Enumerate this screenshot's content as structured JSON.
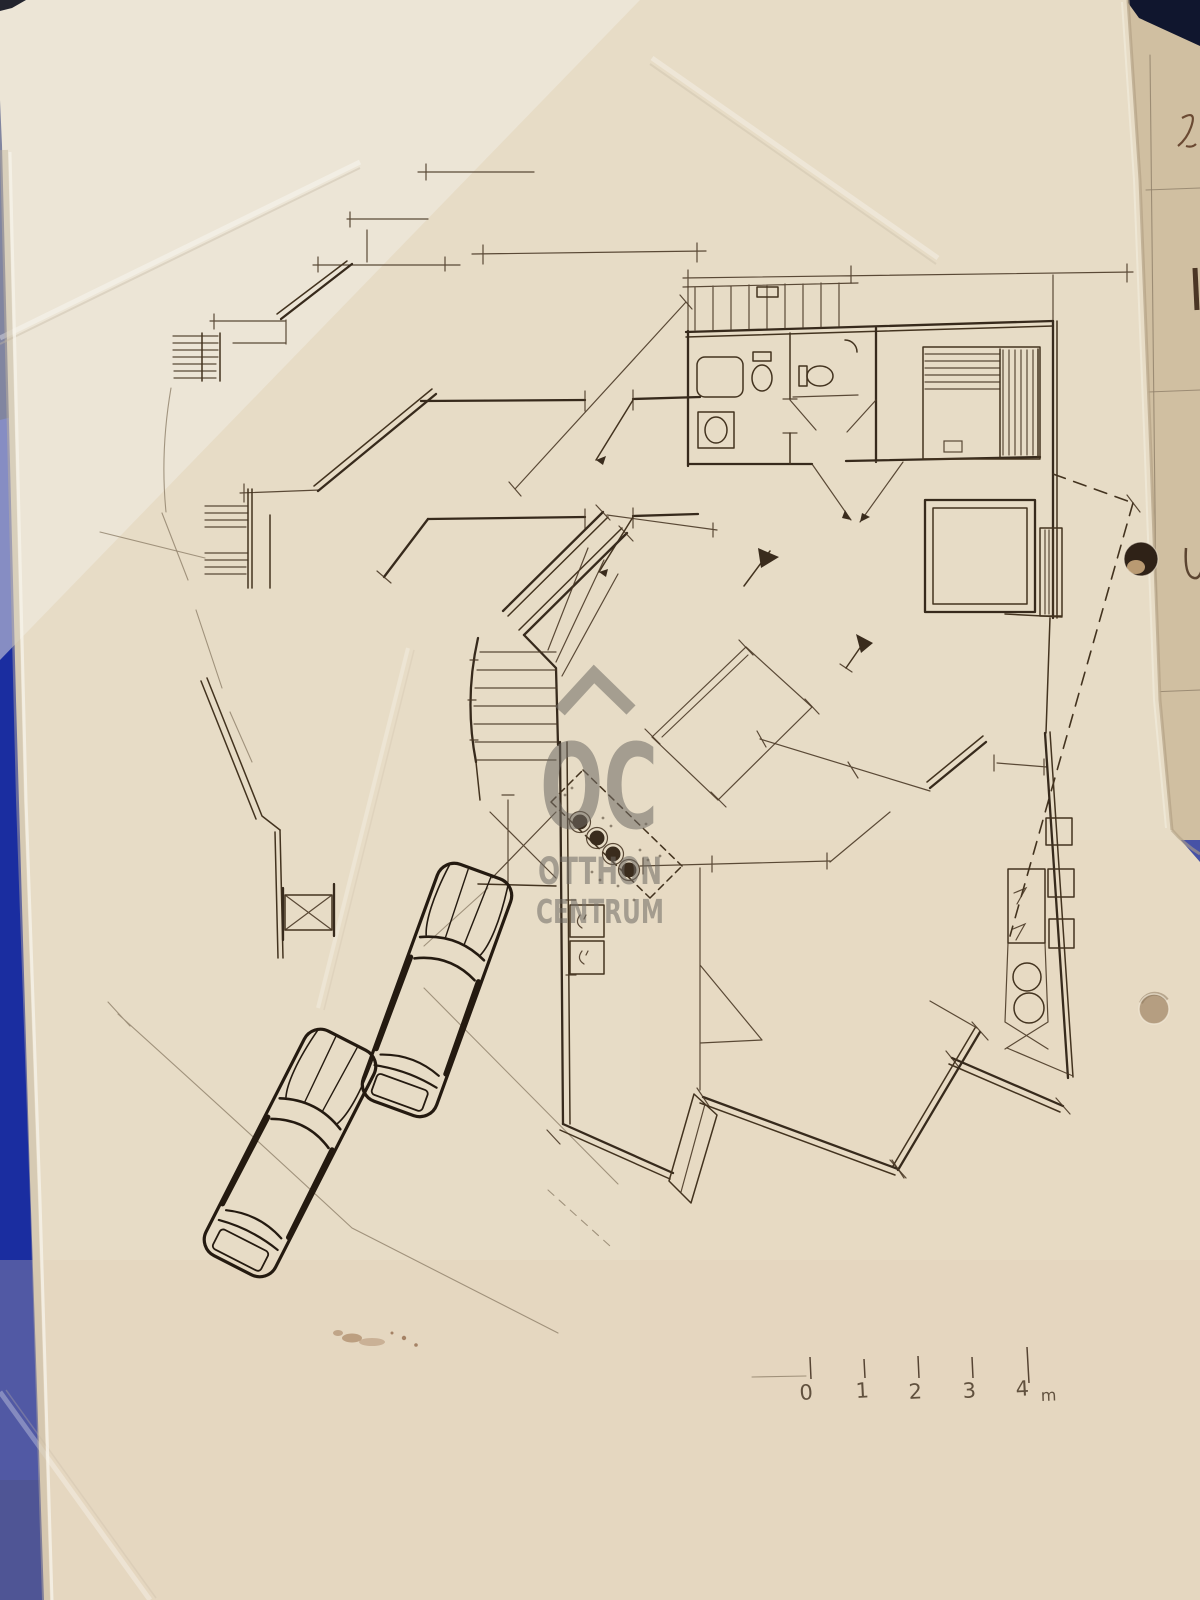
{
  "photo": {
    "subject": "hand-drawn floor plan sketch on paper",
    "colors": {
      "paper": "#e7dcc6",
      "ink": "#3a2c1d",
      "pencil": "#8f7f69",
      "backing_blue": "#1c2f9f",
      "backing_navy": "#141b38",
      "second_sheet": "#d0bfa1",
      "watermark_gray": "#6f6b64",
      "hole_dark": "#2f2217",
      "hole_light": "#b59e81"
    }
  },
  "watermark": {
    "monogram": "OC",
    "line1": "OTTHON",
    "line2": "CENTRUM"
  },
  "scale_bar": {
    "labels": [
      "0",
      "1",
      "2",
      "3",
      "4"
    ],
    "unit_label": "m"
  }
}
